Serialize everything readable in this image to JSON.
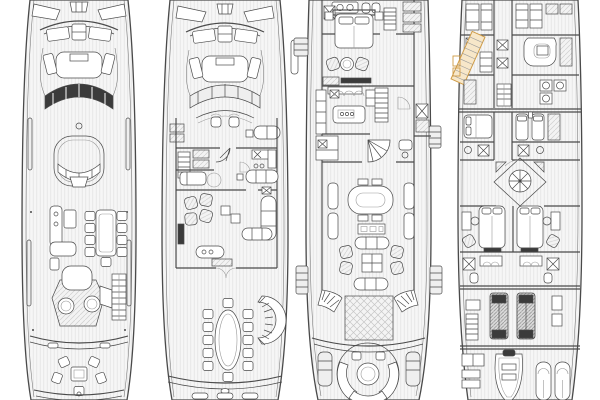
{
  "canvas": {
    "width": 600,
    "height": 400
  },
  "colors": {
    "paper": "#ffffff",
    "ink": "#4a4a4a",
    "ink_soft": "#9a9a9a",
    "dark": "#3b3b3b",
    "accent": "#cf9b45",
    "accent_fill": "#f7e7c9"
  },
  "drawing": {
    "kind": "yacht-general-arrangement",
    "panels": 4
  },
  "decks": [
    {
      "id": "sun-deck",
      "features": [
        "bow-sunpads",
        "forward-seating",
        "dark-windscreen",
        "forward-lounge",
        "bar-counter",
        "dining-table-8",
        "spa-pool",
        "sunpad",
        "stairs",
        "aft-cockpit-table",
        "transom"
      ]
    },
    {
      "id": "bridge-deck",
      "features": [
        "bow-sunpads",
        "forward-seating",
        "wheelhouse-windscreen",
        "helm-chairs",
        "captain-cabin",
        "pantry",
        "skylounge-armchairs",
        "skylounge-sofa",
        "bar",
        "aft-dining-table-12",
        "curved-stairs",
        "passerelle"
      ]
    },
    {
      "id": "main-deck",
      "features": [
        "owner-bathroom",
        "owner-wardrobe",
        "owner-bed",
        "owner-sitting-area",
        "fold-out-balcony",
        "galley-island",
        "staircase",
        "day-head",
        "dining-table",
        "sideboard",
        "salon-sofas",
        "salon-armchairs",
        "aft-lobby-crosshatch",
        "twin-curved-stairs",
        "round-aft-sofa",
        "side-boarding-platforms"
      ]
    },
    {
      "id": "lower-deck",
      "features": [
        "crew-cabins",
        "crew-mess",
        "crew-stairs-highlighted",
        "laundry",
        "guest-cabin-double",
        "guest-cabin-twin",
        "spiral-stair-lobby",
        "guest-cabins-aft-double",
        "guest-bathrooms",
        "engine-room-twin-engines",
        "tender-garage",
        "tender",
        "jet-skis"
      ]
    }
  ]
}
